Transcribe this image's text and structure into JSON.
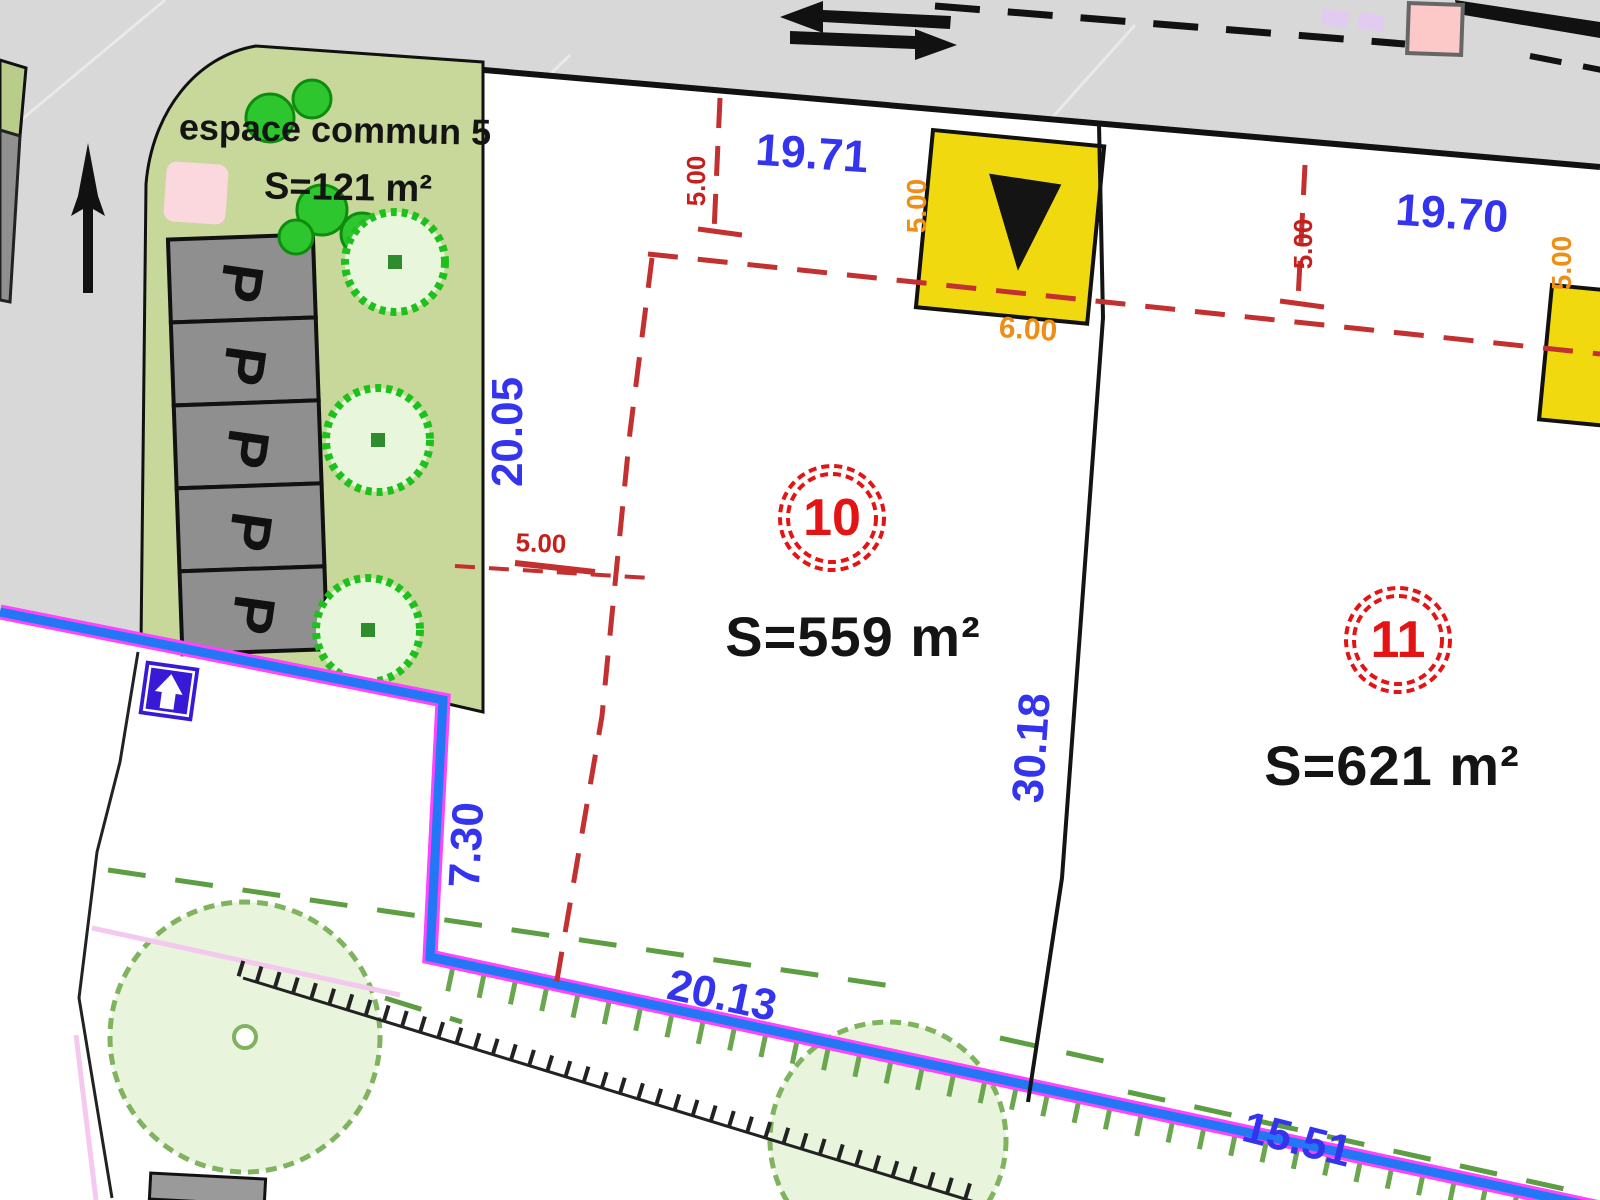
{
  "plan": {
    "kind": "cadastral subdivision site plan",
    "north_arrow": "up",
    "common_area": {
      "label": "espace commun 5",
      "area": "S=121 m²",
      "parking_letter": "P",
      "parking_spaces": 5
    },
    "parcels": [
      {
        "number": "10",
        "area": "S=559 m²"
      },
      {
        "number": "11",
        "area": "S=621 m²"
      }
    ],
    "dimensions": {
      "blue": {
        "lot10_front": "19.71",
        "lot11_front": "19.70",
        "lot10_left": "20.05",
        "lot10_right": "30.18",
        "lot10_left_lower": "7.30",
        "lot10_bottom": "20.13",
        "lot11_bottom": "15.51"
      },
      "red": {
        "lot10_front_setback": "5.00",
        "lot11_front_setback": "5.00",
        "lot10_side_setback": "5.00"
      },
      "orange": {
        "lot10_access_side": "5.00",
        "lot10_access_width": "6.00",
        "lot11_access_side": "5.00"
      }
    },
    "colors": {
      "road_gray": "#d8d8d8",
      "common_area_green": "#c7d89a",
      "parcel_line_black": "#141414",
      "dimension_blue": "#3434ef",
      "setback_red": "#c23030",
      "access_orange": "#ef8e15",
      "access_yellow": "#f0d90f",
      "boundary_blue": "#2277f5",
      "boundary_magenta": "#ff44ff",
      "vegetation_green": "#5d9e42",
      "bright_tree_green": "#1cc11c",
      "pale_tree_fill": "#e8f5dc",
      "parking_gray": "#8f8f8f",
      "sign_indigo": "#3719d6",
      "marker_pink": "#fcc8c8"
    }
  }
}
